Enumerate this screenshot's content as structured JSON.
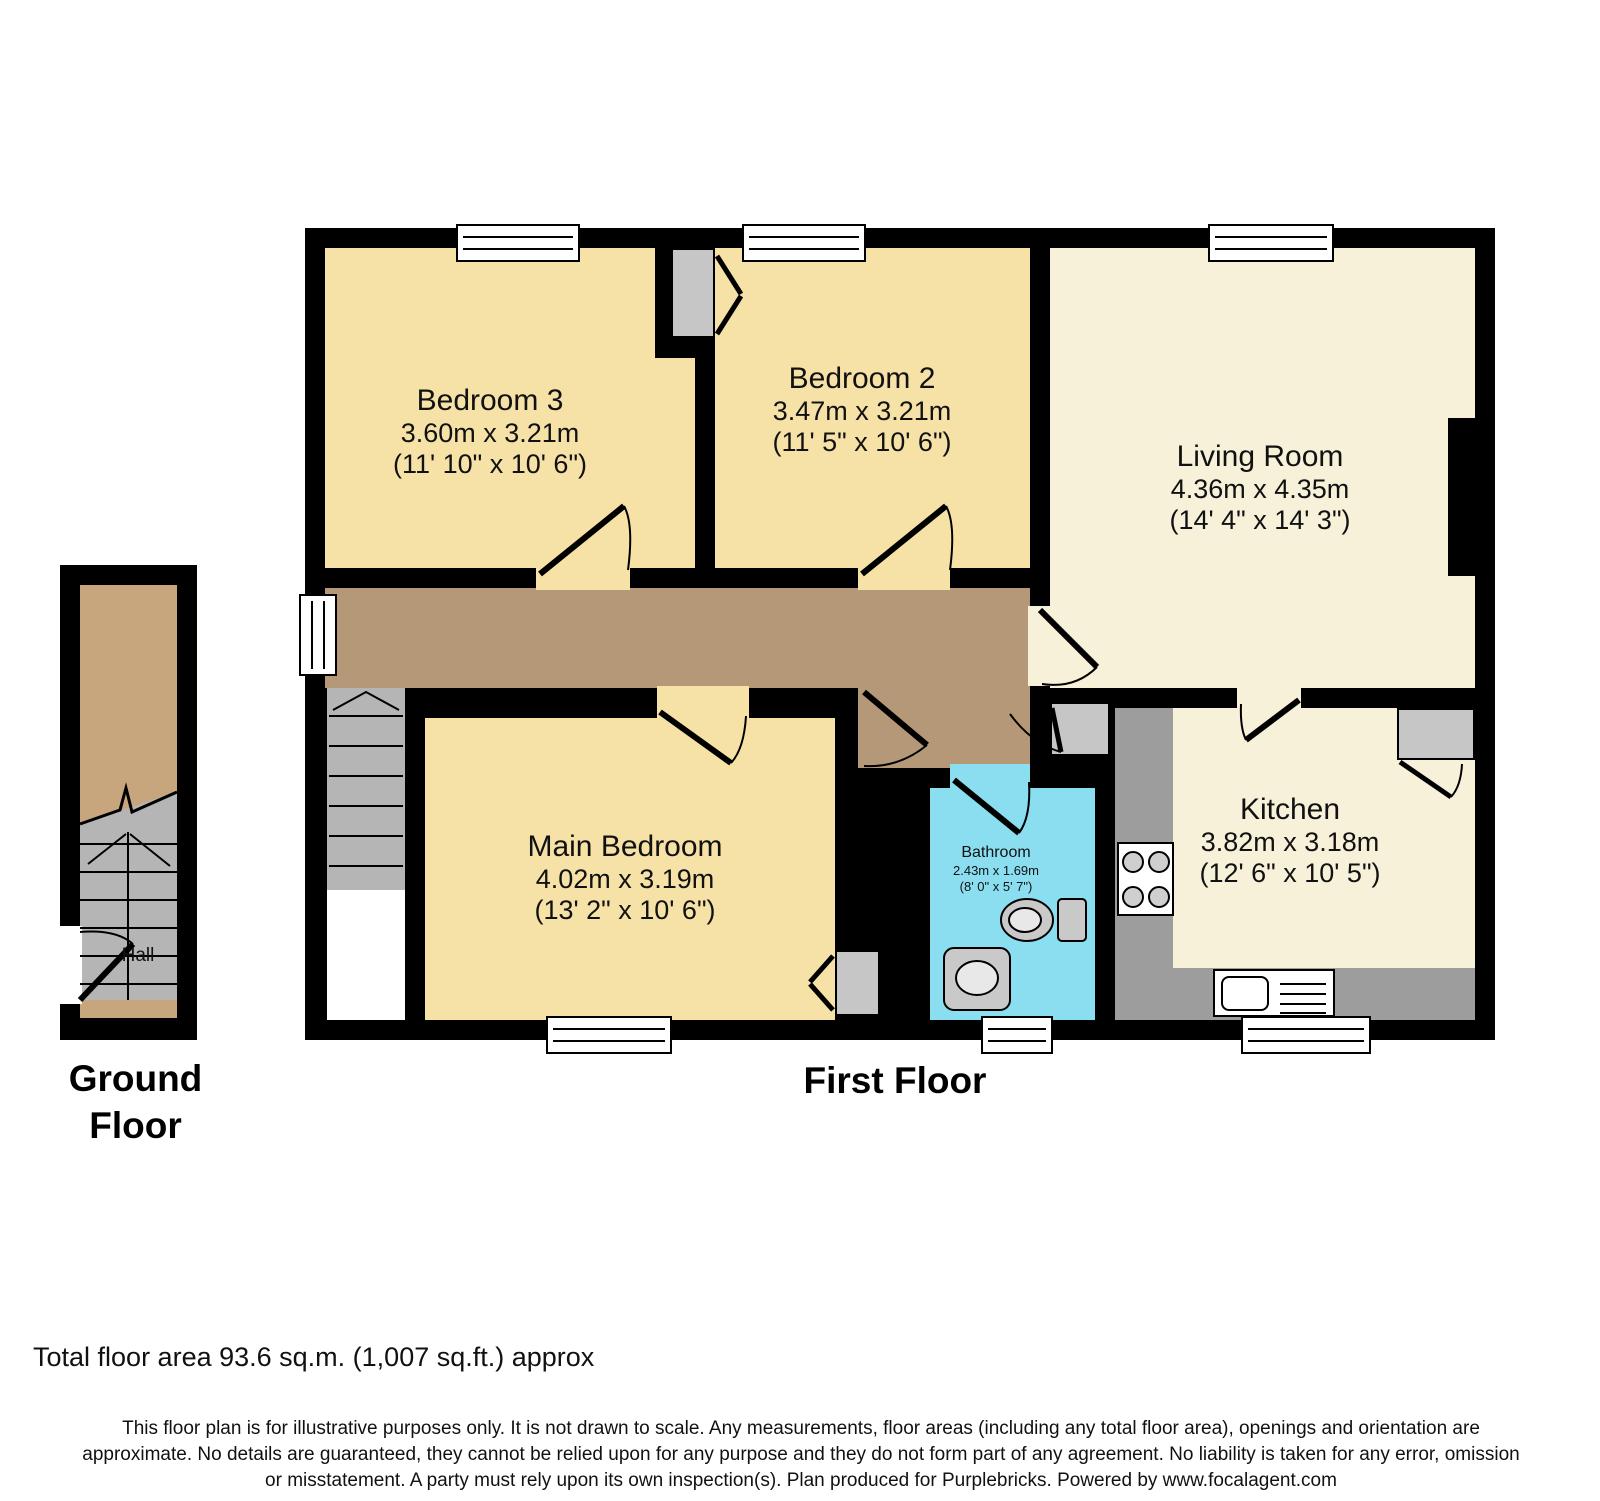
{
  "plan": {
    "type": "residential-floorplan",
    "floors": {
      "ground": {
        "label": "Ground Floor"
      },
      "first": {
        "label": "First Floor"
      }
    },
    "rooms": {
      "bedroom3": {
        "name": "Bedroom 3",
        "dims_m": "3.60m x 3.21m",
        "dims_ft": "(11' 10\" x 10' 6\")"
      },
      "bedroom2": {
        "name": "Bedroom 2",
        "dims_m": "3.47m x 3.21m",
        "dims_ft": "(11' 5\" x 10' 6\")"
      },
      "living": {
        "name": "Living Room",
        "dims_m": "4.36m x 4.35m",
        "dims_ft": "(14' 4\" x 14' 3\")"
      },
      "main_bedroom": {
        "name": "Main Bedroom",
        "dims_m": "4.02m x 3.19m",
        "dims_ft": "(13' 2\" x 10' 6\")"
      },
      "bathroom": {
        "name": "Bathroom",
        "dims_m": "2.43m x 1.69m",
        "dims_ft": "(8' 0\" x 5' 7\")"
      },
      "kitchen": {
        "name": "Kitchen",
        "dims_m": "3.82m x 3.18m",
        "dims_ft": "(12' 6\" x 10' 5\")"
      },
      "hall": {
        "name": "Hall"
      }
    },
    "fixtures": [
      "stairs",
      "stove-hob",
      "kitchen-sink",
      "toilet",
      "wash-basin",
      "wardrobe",
      "closet"
    ],
    "colors": {
      "wall": "#000000",
      "bedroom_fill": "#f6e2a6",
      "living_kitchen_fill": "#f8f1d9",
      "landing_fill": "#b59878",
      "hall_fill": "#c8a67d",
      "bathroom_fill": "#8adef0",
      "stairs_fill": "#b5b5b5",
      "counter_fill": "#9d9d9d"
    }
  },
  "footer": {
    "total_area": "Total floor area 93.6 sq.m. (1,007 sq.ft.) approx",
    "disclaimer_line1": "This floor plan is for illustrative purposes only. It is not drawn to scale. Any measurements, floor areas (including any total floor area), openings and orientation are",
    "disclaimer_line2": "approximate. No details are guaranteed, they cannot be relied upon for any purpose and they do not form part of any agreement. No liability is taken for any error, omission",
    "disclaimer_line3": "or misstatement. A party must rely upon its own inspection(s). Plan produced for Purplebricks. Powered by www.focalagent.com"
  }
}
